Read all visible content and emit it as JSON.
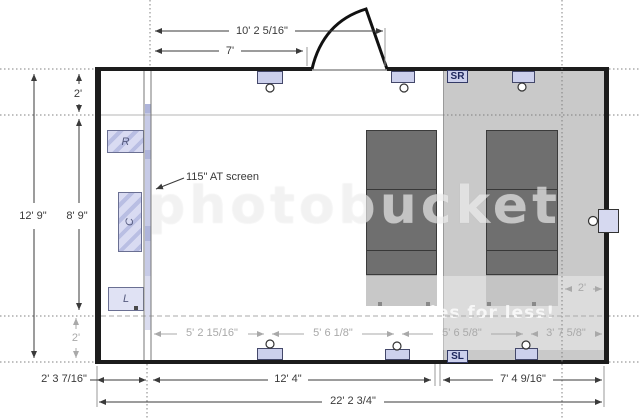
{
  "diagram": {
    "screen_label": "115\" AT screen",
    "speakers": {
      "front_right": "R",
      "center": "C",
      "front_left": "L",
      "surround_right": "SR",
      "surround_left": "SL"
    },
    "dims": {
      "screen_to_door_far": "10' 2 5/16\"",
      "screen_to_door_near": "7'",
      "room_depth": "12' 9\"",
      "speaker_plane_depth": "8' 9\"",
      "top_offset": "2'",
      "bottom_offset": "2'",
      "wall_to_screen": "2' 3 7/16\"",
      "screen_to_riser": "12' 4\"",
      "riser_depth": "7' 4 9/16\"",
      "room_width": "22' 2 3/4\"",
      "span_1": "5' 2 15/16\"",
      "span_2": "5' 6 1/8\"",
      "span_3": "5' 6 5/8\"",
      "span_4": "3' 7 5/8\"",
      "riser_rear_gap": "2'"
    },
    "watermark": {
      "brand": "photobucket",
      "tagline": "ies for less!"
    }
  }
}
